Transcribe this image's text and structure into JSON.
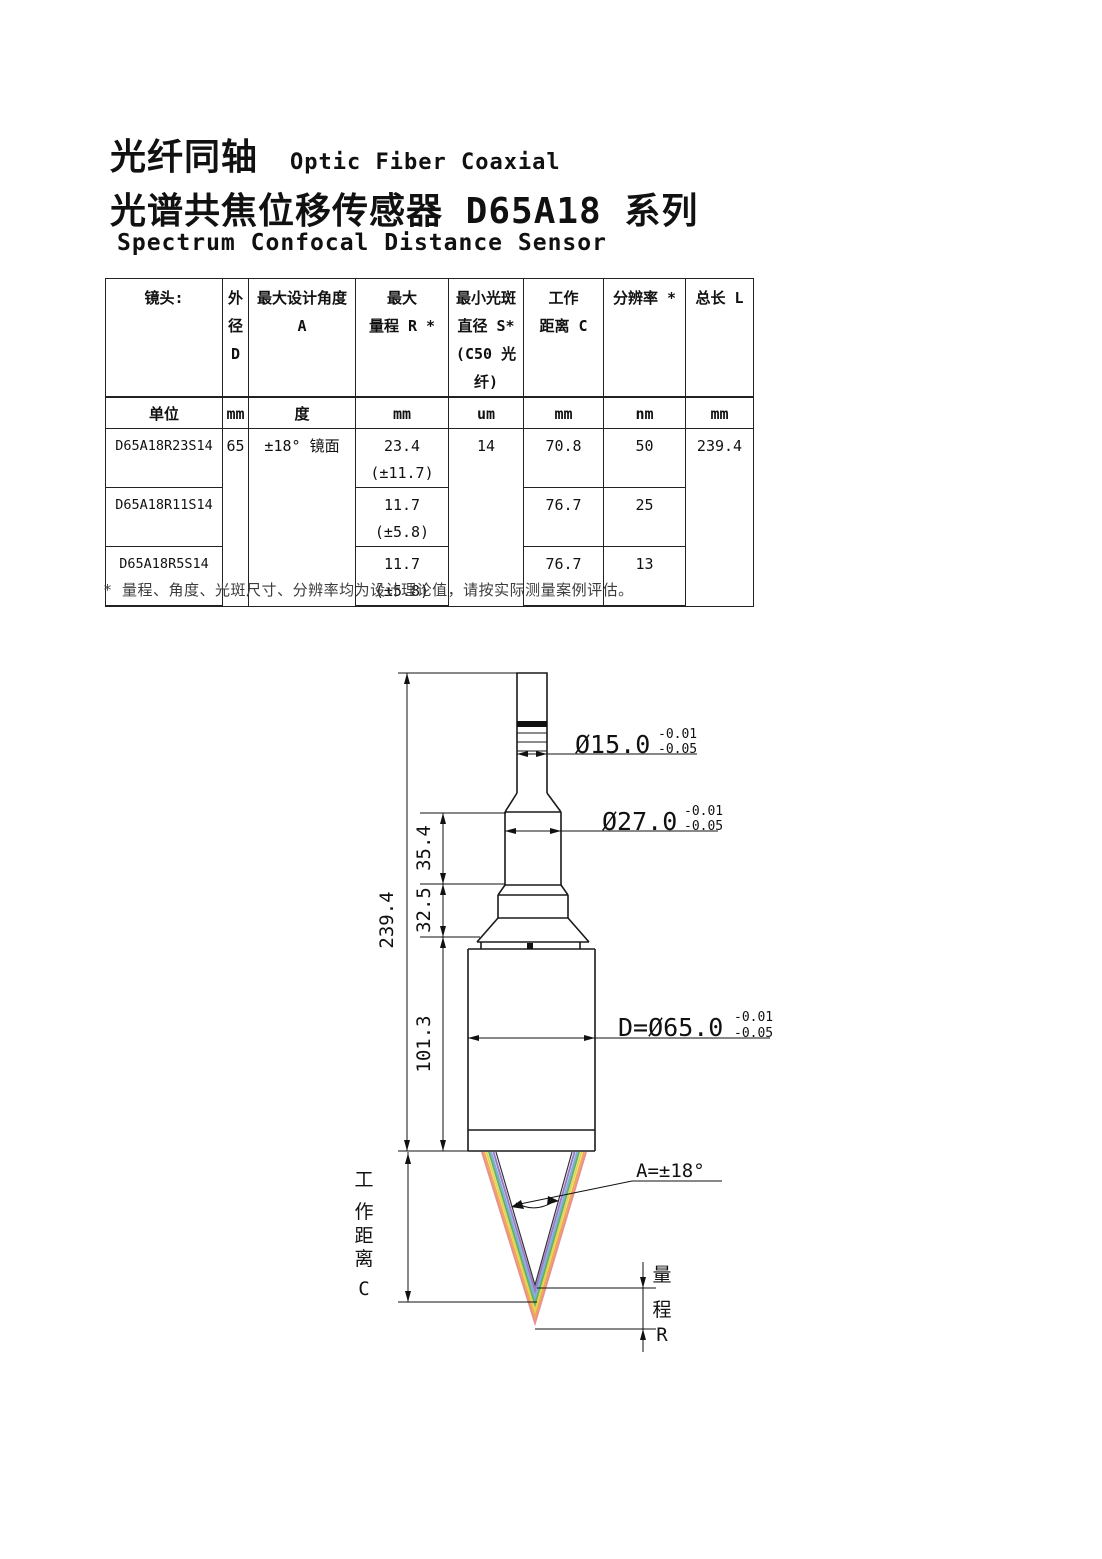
{
  "header": {
    "title_cn_1": "光纤同轴",
    "title_en_1": "Optic Fiber Coaxial",
    "title_cn_2": "光谱共焦位移传感器 D65A18 系列",
    "title_en_2": "Spectrum Confocal Distance Sensor"
  },
  "table": {
    "col_headers": {
      "lens": "镜头:",
      "od": [
        "外",
        "径",
        "D"
      ],
      "angle": "最大设计角度 A",
      "range": [
        "最大",
        "量程 R *"
      ],
      "spot": [
        "最小光斑",
        "直径 S*",
        "(C50 光纤)"
      ],
      "wd": [
        "工作",
        "距离 C"
      ],
      "res": "分辨率 *",
      "len": "总长 L"
    },
    "units": [
      "单位",
      "mm",
      "度",
      "mm",
      "um",
      "mm",
      "nm",
      "mm"
    ],
    "rows": [
      {
        "model": "D65A18R23S14",
        "od": "65",
        "angle": "±18° 镜面",
        "range1": "23.4",
        "range2": "(±11.7)",
        "spot": "14",
        "wd": "70.8",
        "res": "50",
        "len": "239.4"
      },
      {
        "model": "D65A18R11S14",
        "range1": "11.7",
        "range2": "(±5.8)",
        "wd": "76.7",
        "res": "25"
      },
      {
        "model": "D65A18R5S14",
        "range1": "11.7",
        "range2": "(±5.8)",
        "wd": "76.7",
        "res": "13"
      }
    ]
  },
  "footnote": "* 量程、角度、光斑尺寸、分辨率均为设计理论值，请按实际测量案例评估。",
  "diagram": {
    "total_length": "239.4",
    "seg_top": "35.4",
    "seg_mid": "32.5",
    "seg_body": "101.3",
    "dia_fiber": "Ø15.0",
    "dia_neck": "Ø27.0",
    "dia_body": "D=Ø65.0",
    "tol_up": "-0.01",
    "tol_dn": "-0.05",
    "angle": "A=±18°",
    "wd_label": [
      "工",
      "作",
      "距",
      "离",
      "C"
    ],
    "range_label": [
      "量",
      "程",
      "R"
    ],
    "spectrum": [
      "#e89090",
      "#efa852",
      "#e4d44e",
      "#63b163",
      "#7fb0dd",
      "#9b79c8",
      "#333333"
    ]
  }
}
